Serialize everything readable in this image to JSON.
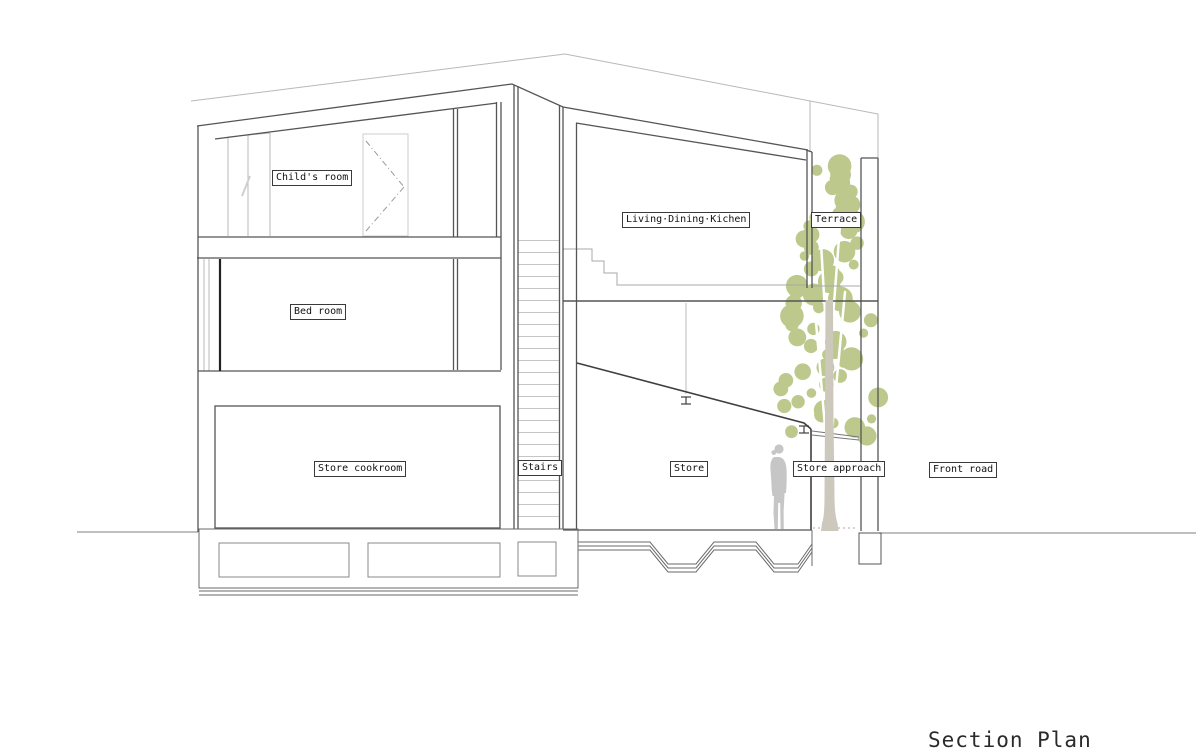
{
  "title": {
    "text": "Section Plan"
  },
  "labels": {
    "childs_room": "Child's room",
    "bed_room": "Bed room",
    "store_cookroom": "Store cookroom",
    "stairs": "Stairs",
    "living_dining_kitchen": "Living·Dining·Kichen",
    "terrace": "Terrace",
    "store": "Store",
    "store_approach": "Store approach",
    "front_road": "Front road"
  },
  "colors": {
    "background": "#ffffff",
    "line_dark": "#555555",
    "line_medium": "#777777",
    "line_light": "#b8b8b8",
    "foliage": "#bdc98c",
    "trunk": "#cdc8bc",
    "person": "#c6c6c6",
    "label_border": "#3a3a3a",
    "label_text": "#111111",
    "title_text": "#2a2a2a"
  }
}
